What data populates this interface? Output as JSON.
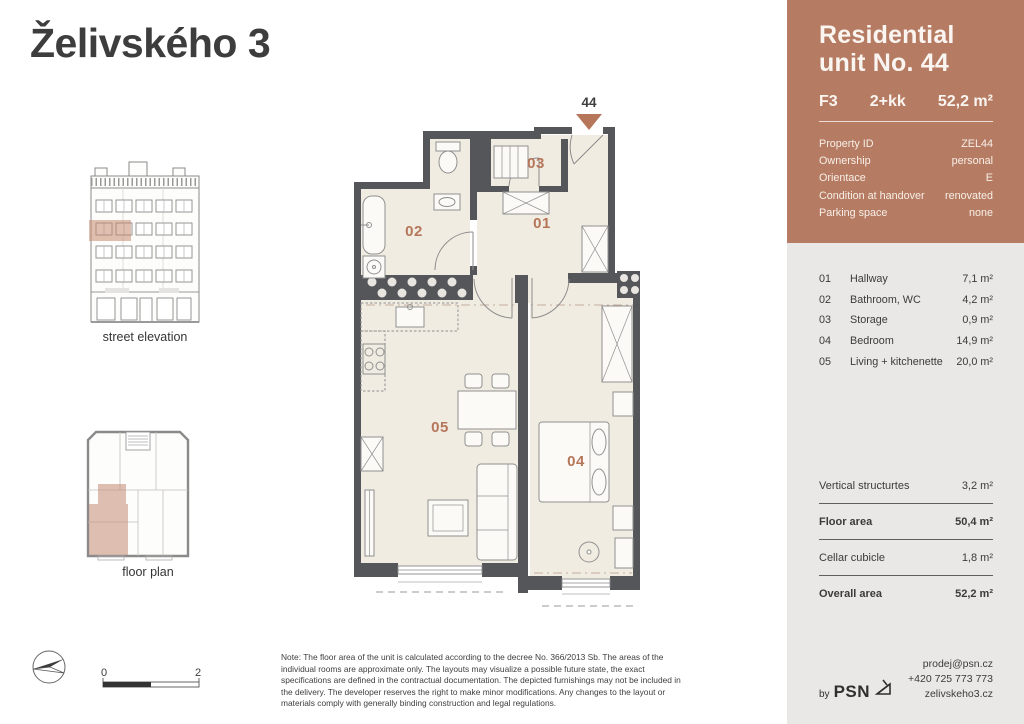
{
  "page_title": "Želivského 3",
  "colors": {
    "accent": "#b5765a",
    "hero_background": "#b57c63",
    "sidebar_background": "#e9e8e6",
    "plan_wall": "#55565a",
    "plan_floor": "#f1ece2",
    "highlight": "#c98a70"
  },
  "icons": {
    "compass": "north-arrow-icon",
    "brand_mark": "psn-scaffold-icon",
    "entrance_marker": "entrance-triangle-icon"
  },
  "thumbnails": {
    "street_elevation_label": "street elevation",
    "floor_plan_label": "floor plan"
  },
  "plan": {
    "unit_marker": "44",
    "room_labels": [
      "01",
      "02",
      "03",
      "04",
      "05"
    ]
  },
  "scale_bar": {
    "start": "0",
    "end": "2"
  },
  "note": "Note: The floor area of the unit is calculated according to the decree No. 366/2013 Sb. The areas of the individual rooms are approximate only. The layouts may visualize a possible future state, the exact specifications are defined in the contractual documentation. The depicted furnishings may not be included in the delivery. The developer reserves the right to make minor modifications. Any changes to the layout or materials comply with generally binding construction and legal regulations.",
  "sidebar": {
    "title_line1": "Residential",
    "title_line2": "unit No. 44",
    "summary": {
      "unit_type": "F3",
      "disposition": "2+kk",
      "area": "52,2 m²"
    },
    "properties": [
      {
        "label": "Property ID",
        "value": "ZEL44"
      },
      {
        "label": "Ownership",
        "value": "personal"
      },
      {
        "label": "Orientace",
        "value": "E"
      },
      {
        "label": "Condition at handover",
        "value": "renovated"
      },
      {
        "label": "Parking space",
        "value": "none"
      }
    ],
    "rooms": [
      {
        "number": "01",
        "name": "Hallway",
        "area": "7,1 m²"
      },
      {
        "number": "02",
        "name": "Bathroom, WC",
        "area": "4,2 m²"
      },
      {
        "number": "03",
        "name": "Storage",
        "area": "0,9 m²"
      },
      {
        "number": "04",
        "name": "Bedroom",
        "area": "14,9 m²"
      },
      {
        "number": "05",
        "name": "Living + kitchenette",
        "area": "20,0 m²"
      }
    ],
    "areas": [
      {
        "label": "Vertical structurtes",
        "value": "3,2 m²"
      },
      {
        "label": "Floor area",
        "value": "50,4 m²"
      },
      {
        "label": "Cellar cubicle",
        "value": "1,8 m²"
      },
      {
        "label": "Overall area",
        "value": "52,2 m²"
      }
    ],
    "footer": {
      "by": "by",
      "brand": "PSN",
      "email": "prodej@psn.cz",
      "phone": "+420 725 773 773",
      "website": "zelivskeho3.cz"
    }
  }
}
